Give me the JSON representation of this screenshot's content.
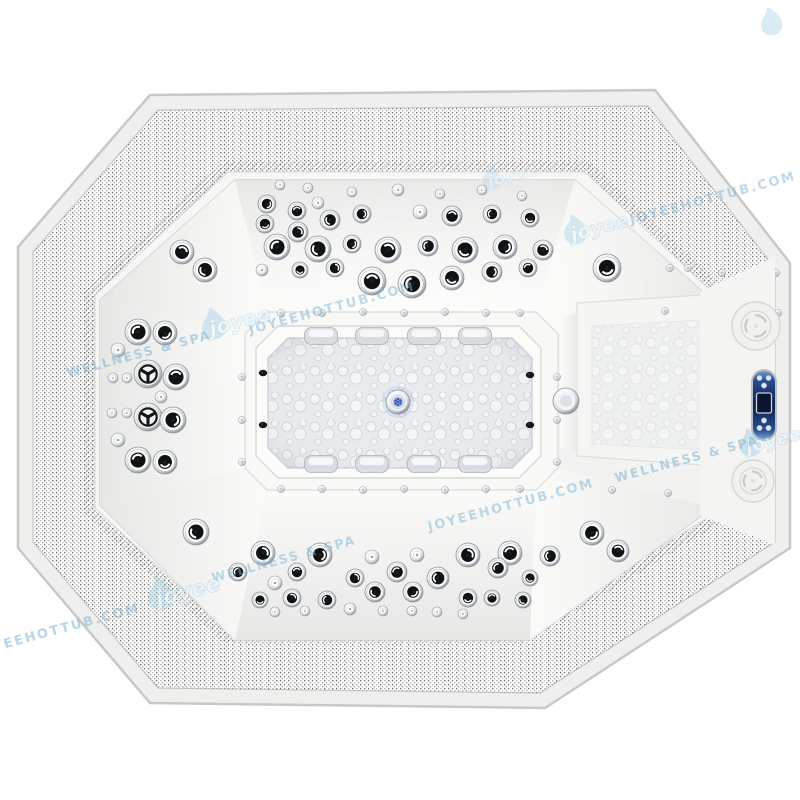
{
  "scene": {
    "subject": "Top view product photo of a white octagonal outdoor hot tub spa with massage jets",
    "background_color": "#ffffff",
    "shell_color": "#f5f5f3",
    "mesh_dot_color": "#585858"
  },
  "brand": {
    "logo_text": "joyee",
    "tagline": "WELLNESS & SPA",
    "url": "JOYEEHOTTUB.COM",
    "watermark_color": "#7eb4d6",
    "drop_color": "#9ccbe4"
  },
  "watermarks": [
    {
      "type": "logo-drop",
      "x": 792,
      "y": 20,
      "scale": 0.85,
      "opacity": 0.5
    },
    {
      "type": "logo",
      "x": 510,
      "y": 176,
      "scale": 0.75,
      "opacity": 0.35
    },
    {
      "type": "logo",
      "x": 597,
      "y": 228,
      "scale": 0.9,
      "opacity": 0.5
    },
    {
      "type": "url",
      "x": 714,
      "y": 202,
      "opacity": 0.5
    },
    {
      "type": "url",
      "x": 333,
      "y": 312,
      "opacity": 0.5
    },
    {
      "type": "logo",
      "x": 237,
      "y": 322,
      "scale": 0.95,
      "opacity": 0.55
    },
    {
      "type": "tagline",
      "x": 140,
      "y": 358,
      "opacity": 0.55
    },
    {
      "type": "logo-drop",
      "x": 6,
      "y": 390,
      "scale": 0.8,
      "opacity": 0.4
    },
    {
      "type": "logo",
      "x": 771,
      "y": 441,
      "scale": 0.85,
      "opacity": 0.6
    },
    {
      "type": "tagline",
      "x": 688,
      "y": 463,
      "opacity": 0.55
    },
    {
      "type": "tagline",
      "x": 285,
      "y": 563,
      "opacity": 0.5
    },
    {
      "type": "url",
      "x": 512,
      "y": 509,
      "opacity": 0.5
    },
    {
      "type": "logo",
      "x": 185,
      "y": 592,
      "scale": 1.0,
      "opacity": 0.55
    },
    {
      "type": "url",
      "x": 58,
      "y": 634,
      "opacity": 0.55
    }
  ],
  "jet_types": {
    "L": "large eyeball massage jet (chrome ring, dark swirl center)",
    "m": "medium massage jet",
    "s": "small chrome air jet",
    "Y": "large directional jet with Y-spinner"
  },
  "jets": [
    [
      280,
      185,
      5,
      "s"
    ],
    [
      308,
      188,
      5,
      "s"
    ],
    [
      352,
      192,
      5,
      "s"
    ],
    [
      398,
      190,
      6,
      "s"
    ],
    [
      440,
      194,
      5,
      "s"
    ],
    [
      482,
      190,
      5,
      "s"
    ],
    [
      522,
      196,
      5,
      "s"
    ],
    [
      267,
      204,
      9,
      "m"
    ],
    [
      297,
      211,
      9,
      "m"
    ],
    [
      318,
      203,
      6,
      "s"
    ],
    [
      330,
      220,
      10,
      "m"
    ],
    [
      362,
      214,
      9,
      "m"
    ],
    [
      420,
      212,
      7,
      "s"
    ],
    [
      452,
      216,
      10,
      "m"
    ],
    [
      492,
      214,
      9,
      "m"
    ],
    [
      530,
      218,
      9,
      "m"
    ],
    [
      265,
      224,
      9,
      "m"
    ],
    [
      298,
      232,
      10,
      "m"
    ],
    [
      352,
      244,
      9,
      "m"
    ],
    [
      428,
      246,
      10,
      "m"
    ],
    [
      543,
      250,
      10,
      "m"
    ],
    [
      277,
      247,
      13,
      "L"
    ],
    [
      318,
      249,
      13,
      "L"
    ],
    [
      388,
      250,
      13,
      "L"
    ],
    [
      465,
      250,
      13,
      "L"
    ],
    [
      505,
      247,
      12,
      "L"
    ],
    [
      262,
      270,
      6,
      "s"
    ],
    [
      300,
      270,
      8,
      "m"
    ],
    [
      335,
      268,
      9,
      "m"
    ],
    [
      372,
      281,
      14,
      "L"
    ],
    [
      412,
      284,
      14,
      "L"
    ],
    [
      452,
      278,
      12,
      "L"
    ],
    [
      492,
      272,
      10,
      "m"
    ],
    [
      528,
      268,
      9,
      "m"
    ],
    [
      138,
      332,
      13,
      "L"
    ],
    [
      165,
      333,
      12,
      "L"
    ],
    [
      118,
      350,
      7,
      "s"
    ],
    [
      148,
      374,
      14,
      "Y"
    ],
    [
      176,
      377,
      13,
      "L"
    ],
    [
      113,
      378,
      5,
      "s"
    ],
    [
      127,
      378,
      5,
      "s"
    ],
    [
      161,
      397,
      6,
      "s"
    ],
    [
      112,
      413,
      5,
      "s"
    ],
    [
      127,
      413,
      5,
      "s"
    ],
    [
      148,
      417,
      14,
      "Y"
    ],
    [
      173,
      420,
      13,
      "L"
    ],
    [
      118,
      440,
      7,
      "s"
    ],
    [
      138,
      460,
      13,
      "L"
    ],
    [
      165,
      462,
      12,
      "L"
    ],
    [
      182,
      252,
      12,
      "L"
    ],
    [
      205,
      270,
      12,
      "L"
    ],
    [
      607,
      268,
      14,
      "L"
    ],
    [
      592,
      533,
      12,
      "L"
    ],
    [
      618,
      551,
      11,
      "L"
    ],
    [
      196,
      532,
      13,
      "L"
    ],
    [
      238,
      572,
      9,
      "m"
    ],
    [
      263,
      553,
      12,
      "L"
    ],
    [
      320,
      555,
      12,
      "L"
    ],
    [
      372,
      557,
      7,
      "s"
    ],
    [
      417,
      555,
      7,
      "s"
    ],
    [
      468,
      555,
      12,
      "L"
    ],
    [
      510,
      553,
      12,
      "L"
    ],
    [
      550,
      556,
      10,
      "m"
    ],
    [
      275,
      583,
      7,
      "s"
    ],
    [
      297,
      572,
      9,
      "m"
    ],
    [
      355,
      578,
      9,
      "m"
    ],
    [
      397,
      572,
      10,
      "m"
    ],
    [
      438,
      578,
      11,
      "L"
    ],
    [
      498,
      568,
      10,
      "m"
    ],
    [
      530,
      578,
      8,
      "m"
    ],
    [
      260,
      600,
      8,
      "m"
    ],
    [
      292,
      598,
      9,
      "m"
    ],
    [
      327,
      600,
      9,
      "m"
    ],
    [
      375,
      592,
      10,
      "m"
    ],
    [
      413,
      592,
      10,
      "m"
    ],
    [
      468,
      598,
      9,
      "m"
    ],
    [
      492,
      598,
      8,
      "m"
    ],
    [
      523,
      600,
      8,
      "m"
    ],
    [
      275,
      612,
      5,
      "s"
    ],
    [
      305,
      611,
      5,
      "s"
    ],
    [
      350,
      609,
      6,
      "s"
    ],
    [
      383,
      611,
      5,
      "s"
    ],
    [
      412,
      611,
      5,
      "s"
    ],
    [
      437,
      612,
      5,
      "s"
    ],
    [
      463,
      614,
      5,
      "s"
    ]
  ],
  "rivets": [
    [
      281,
      313
    ],
    [
      322,
      313
    ],
    [
      363,
      312
    ],
    [
      404,
      313
    ],
    [
      445,
      312
    ],
    [
      486,
      313
    ],
    [
      520,
      313
    ],
    [
      281,
      489
    ],
    [
      322,
      489
    ],
    [
      363,
      490
    ],
    [
      404,
      489
    ],
    [
      445,
      490
    ],
    [
      486,
      489
    ],
    [
      520,
      489
    ],
    [
      242,
      377
    ],
    [
      242,
      420
    ],
    [
      242,
      462
    ],
    [
      557,
      377
    ],
    [
      557,
      420
    ],
    [
      557,
      462
    ],
    [
      665,
      311
    ],
    [
      722,
      317
    ],
    [
      778,
      313
    ],
    [
      612,
      490
    ],
    [
      668,
      493
    ],
    [
      725,
      491
    ],
    [
      670,
      268
    ],
    [
      688,
      268
    ],
    [
      722,
      273
    ],
    [
      776,
      273
    ]
  ],
  "air_ports": [
    [
      263,
      373
    ],
    [
      263,
      425
    ],
    [
      530,
      375
    ],
    [
      530,
      425
    ]
  ],
  "pillows": {
    "width": 33,
    "height": 17,
    "x_centers": [
      321,
      372,
      424,
      475
    ],
    "rows_y": [
      336,
      464
    ]
  },
  "drain": {
    "x": 398,
    "y": 402,
    "r": 12,
    "led_color": "#3f63c8"
  },
  "bench_light": {
    "x": 566,
    "y": 401,
    "r": 13
  },
  "medallions": [
    {
      "x": 756,
      "y": 326,
      "r": 24
    },
    {
      "x": 753,
      "y": 481,
      "r": 21
    }
  ],
  "control_panel": {
    "x": 764,
    "y": 405,
    "width": 24,
    "height": 70,
    "body_color": "#14306b",
    "display": true,
    "button_count": 6
  }
}
